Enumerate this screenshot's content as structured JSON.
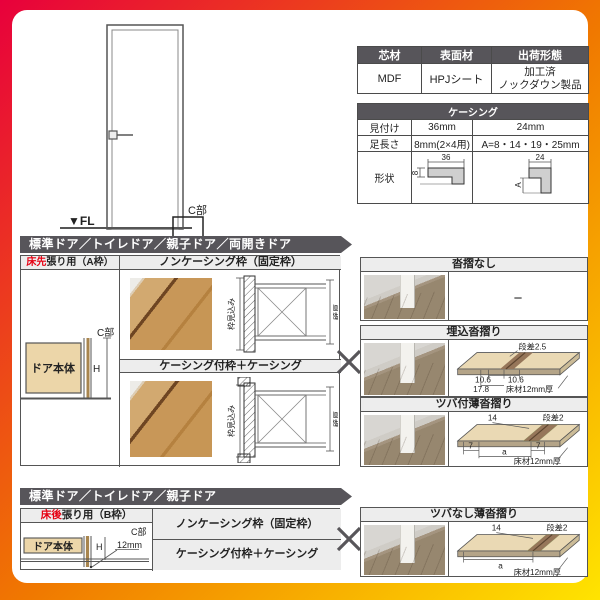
{
  "door_elevation": {
    "fl_label": "▼FL",
    "c_label": "C部"
  },
  "spec_table": {
    "headers": [
      "芯材",
      "表面材",
      "出荷形態"
    ],
    "core": "MDF",
    "surface": "HPJシート",
    "shipping_line1": "加工済",
    "shipping_line2": "ノックダウン製品"
  },
  "casing_table": {
    "title": "ケーシング",
    "row_labels": [
      "見付け",
      "足長さ",
      "形状"
    ],
    "mitsuke": [
      "36mm",
      "24mm"
    ],
    "ashinagasa": [
      "8mm(2×4用)",
      "A=8・14・19・25mm"
    ],
    "shape36": {
      "top": "36",
      "left": "8"
    },
    "shape24": {
      "top": "24",
      "left": "A"
    }
  },
  "banner1": "標準ドア／トイレドア／親子ドア／両開きドア",
  "banner2": "標準ドア／トイレドア／親子ドア",
  "section_a": {
    "left_header_red": "床先",
    "left_header_rest": "張り用（A枠）",
    "frame1_title": "ノンケーシング枠（固定枠）",
    "frame2_title": "ケーシング付枠＋ケーシング",
    "diagram": {
      "c_label": "C部",
      "h_label": "H",
      "door_label": "ドア本体"
    },
    "cross_labels": {
      "depth": "枠見込み",
      "wall": "壁厚"
    }
  },
  "section_b": {
    "left_header_red": "床後",
    "left_header_rest": "張り用（B枠）",
    "frame1_title": "ノンケーシング枠（固定枠）",
    "frame2_title": "ケーシング付枠＋ケーシング",
    "diagram": {
      "c_label": "C部",
      "h_label": "H",
      "door_label": "ドア本体",
      "depth_label": "12mm"
    }
  },
  "sills": {
    "none": {
      "title": "沓摺なし",
      "value": "−"
    },
    "umekomi": {
      "title": "埋込沓摺り",
      "labels": {
        "step": "段差2.5",
        "w1": "10.6",
        "w2": "10.6",
        "w3": "17.8",
        "floor": "床材12mm厚"
      }
    },
    "tsubatsuki": {
      "title": "ツバ付薄沓摺り",
      "labels": {
        "top": "14",
        "step": "段差2",
        "d1": "7",
        "d2": "a",
        "d3": "7",
        "floor": "床材12mm厚"
      }
    },
    "tsubanashi": {
      "title": "ツバなし薄沓摺り",
      "labels": {
        "top": "14",
        "step": "段差2",
        "d2": "a",
        "floor": "床材12mm厚"
      }
    }
  },
  "colors": {
    "accent_red": "#e60012",
    "banner_gray": "#57555a",
    "header_gray": "#ededed"
  }
}
